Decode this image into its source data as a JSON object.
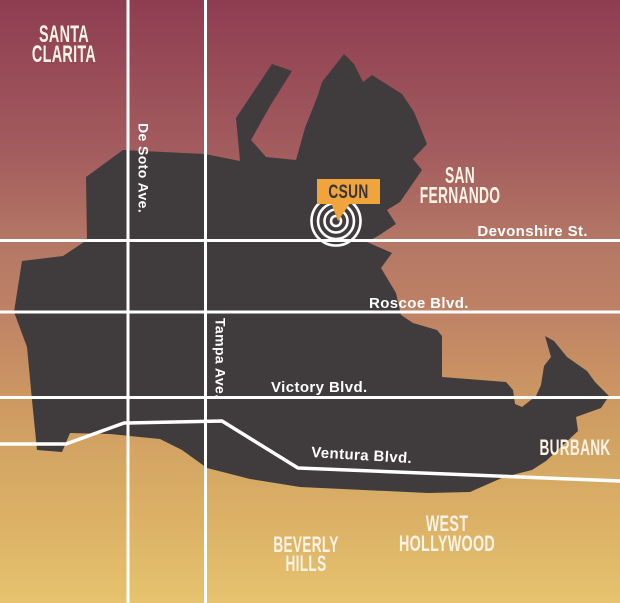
{
  "map": {
    "title": "CSUN area locator map",
    "marker": {
      "label": "CSUN"
    },
    "regions": [
      {
        "id": "santa-clarita",
        "lines": [
          "SANTA",
          "CLARITA"
        ]
      },
      {
        "id": "san-fernando",
        "lines": [
          "SAN",
          "FERNANDO"
        ]
      },
      {
        "id": "burbank",
        "lines": [
          "BURBANK"
        ]
      },
      {
        "id": "west-hollywood",
        "lines": [
          "WEST",
          "HOLLYWOOD"
        ]
      },
      {
        "id": "beverly-hills",
        "lines": [
          "BEVERLY",
          "HILLS"
        ]
      }
    ],
    "streets": [
      {
        "id": "de-soto",
        "label": "De Soto Ave.",
        "orientation": "vertical"
      },
      {
        "id": "tampa",
        "label": "Tampa Ave.",
        "orientation": "vertical"
      },
      {
        "id": "devonshire",
        "label": "Devonshire St.",
        "orientation": "horizontal"
      },
      {
        "id": "roscoe",
        "label": "Roscoe Blvd.",
        "orientation": "horizontal"
      },
      {
        "id": "victory",
        "label": "Victory Blvd.",
        "orientation": "horizontal"
      },
      {
        "id": "ventura",
        "label": "Ventura Blvd.",
        "orientation": "curved"
      }
    ],
    "colors": {
      "background_top": "#8e3d51",
      "background_mid": "#bf8265",
      "background_bottom": "#e6c36e",
      "land": "#403b3c",
      "road": "#ffffff",
      "label": "#fbf3e6",
      "marker_background": "#f0a43c",
      "marker_text": "#38333b"
    }
  }
}
